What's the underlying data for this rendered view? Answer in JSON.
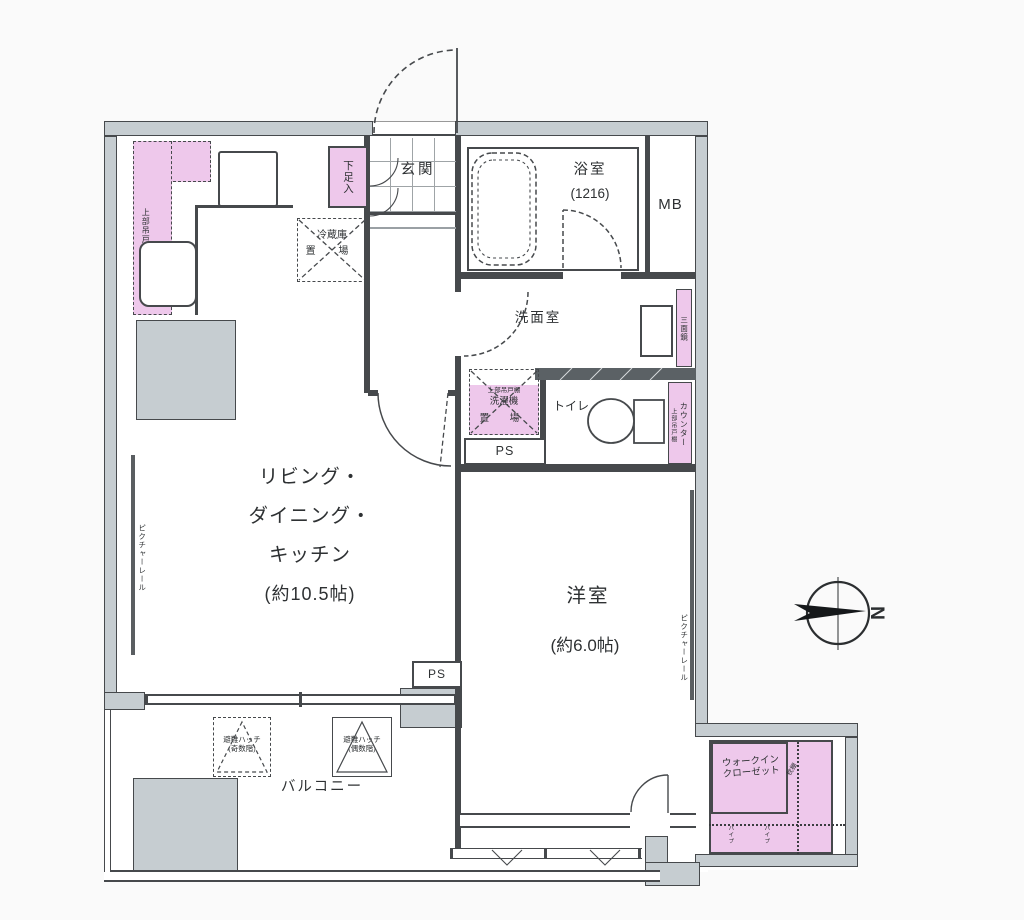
{
  "plan": {
    "rooms": {
      "entrance": {
        "label": "玄関"
      },
      "bathroom": {
        "label": "浴室",
        "size": "(1216)"
      },
      "meter_box": {
        "label": "MB"
      },
      "washroom": {
        "label": "洗面室"
      },
      "toilet": {
        "label": "トイレ"
      },
      "ldk": {
        "line1": "リビング・",
        "line2": "ダイニング・",
        "line3": "キッチン",
        "line4": "(約10.5帖)"
      },
      "western_room": {
        "label": "洋室",
        "size": "(約6.0帖)"
      },
      "balcony": {
        "label": "バルコニー"
      },
      "walk_in_closet": {
        "line1": "ウォークイン",
        "line2": "クローゼット"
      }
    },
    "fixtures": {
      "shoe_cabinet": "下足入",
      "upper_cabinet": "上部吊戸棚",
      "refrigerator_line1": "冷蔵庫",
      "refrigerator_line2": "置 場",
      "washer_line1": "洗濯機",
      "washer_line2": "置 場",
      "pipe_space": "PS",
      "mirror": "三面鏡",
      "counter": "カウンター",
      "picture_rail": "ピクチャーレール",
      "hatch_odd_line1": "避難ハッチ",
      "hatch_odd_line2": "(奇数階)",
      "hatch_even_line1": "避難ハッチ",
      "hatch_even_line2": "(偶数階)",
      "wic_shelf": "枕棚",
      "wic_pipe": "パイプ"
    },
    "compass": {
      "north_label": "N"
    },
    "colors": {
      "wall": "#46494c",
      "wall_fill": "#c6cdd1",
      "facility_pink": "#eec8eb",
      "background": "#fafafa",
      "text": "#2e3133"
    }
  }
}
